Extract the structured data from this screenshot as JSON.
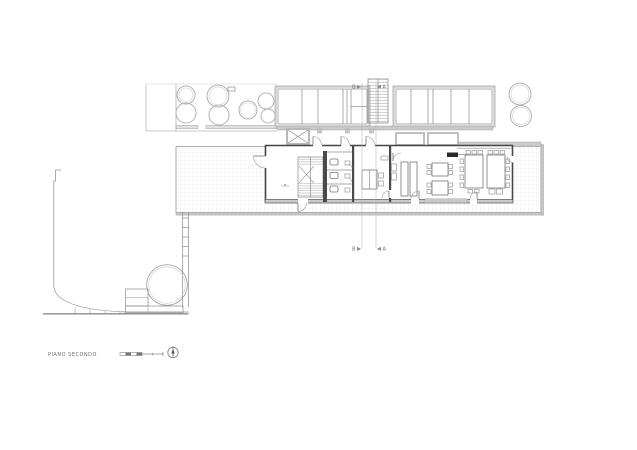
{
  "sheet": {
    "title": "PIANO SECONDO",
    "width_px": 637,
    "height_px": 450,
    "background": "#ffffff"
  },
  "section_markers": {
    "b": "B",
    "a": "A"
  },
  "colors": {
    "wall_dark": "#454545",
    "line_medium": "#8c8c8c",
    "line_light": "#b5b5b5",
    "parapet_gray": "#c9c9c9",
    "grid_line": "#e3e3e3",
    "fill_dark": "#2a2a2a",
    "label_text": "#6f6f6f"
  },
  "icons": [
    {
      "name": "north-arrow-icon",
      "glyph": "circle-with-up-arrow"
    },
    {
      "name": "scale-bar",
      "glyph": "alternating-graphic-scale"
    },
    {
      "name": "tree-icon",
      "glyph": "double-circle"
    },
    {
      "name": "elevator-icon",
      "glyph": "crossed-box"
    },
    {
      "name": "stair-icon",
      "glyph": "hatched-treads"
    },
    {
      "name": "door-swing-icon",
      "glyph": "quarter-arc"
    }
  ]
}
